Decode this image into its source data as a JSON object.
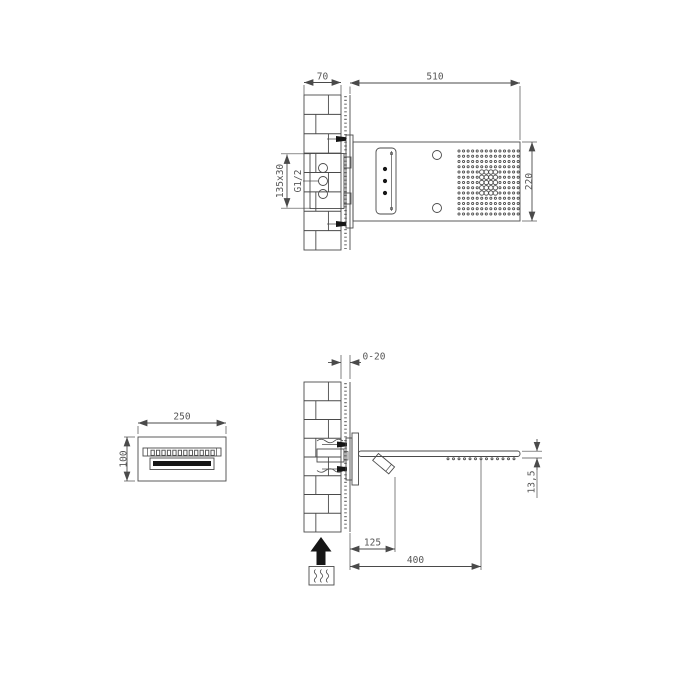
{
  "drawing": {
    "top_view": {
      "dim_wall_depth": "70",
      "dim_length": "510",
      "dim_width": "220",
      "dim_valve_box": "135x30",
      "thread_label": "G1/2",
      "rain_grid": {
        "cols": 14,
        "rows": 13,
        "bold_cols": [
          5,
          8
        ],
        "bold_rows": [
          4,
          8
        ]
      }
    },
    "side_view": {
      "dim_tile_range": "0-20",
      "dim_spout_offset": "125",
      "dim_arm_reach": "400",
      "dim_plate_thickness": "13,5",
      "nozzle_count": 13
    },
    "front_view": {
      "dim_width": "250",
      "dim_height": "100",
      "hatch_count": 12
    },
    "icons": {
      "up_arrow": "mounting-direction-up",
      "water_box": "water-flow-symbol"
    },
    "colors": {
      "line": "#4a4a4a",
      "text": "#555555",
      "black": "#161616"
    }
  }
}
